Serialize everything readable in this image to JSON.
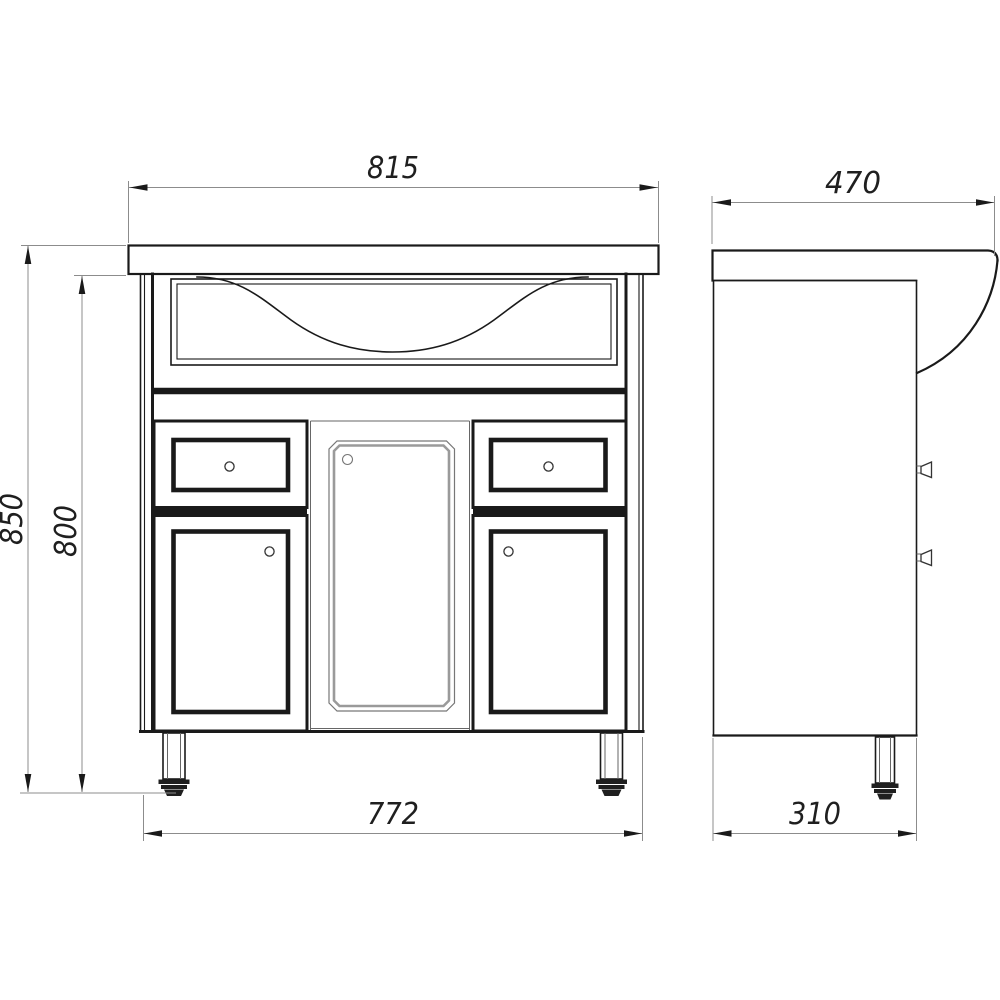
{
  "drawing_type": "furniture technical drawing: bathroom vanity cabinet with sink, front and side orthographic views",
  "views": {
    "front": "front view",
    "side": "side view"
  },
  "dimensions": {
    "countertop_width": "815",
    "countertop_depth": "470",
    "overall_height": "850",
    "cabinet_height": "800",
    "cabinet_width": "772",
    "cabinet_depth": "310"
  },
  "colors": {
    "background": "#ffffff",
    "outline": "#1a1a1a",
    "dimension_line": "#8c8c8c",
    "recessed_panel_line": "#9a9a9a"
  }
}
